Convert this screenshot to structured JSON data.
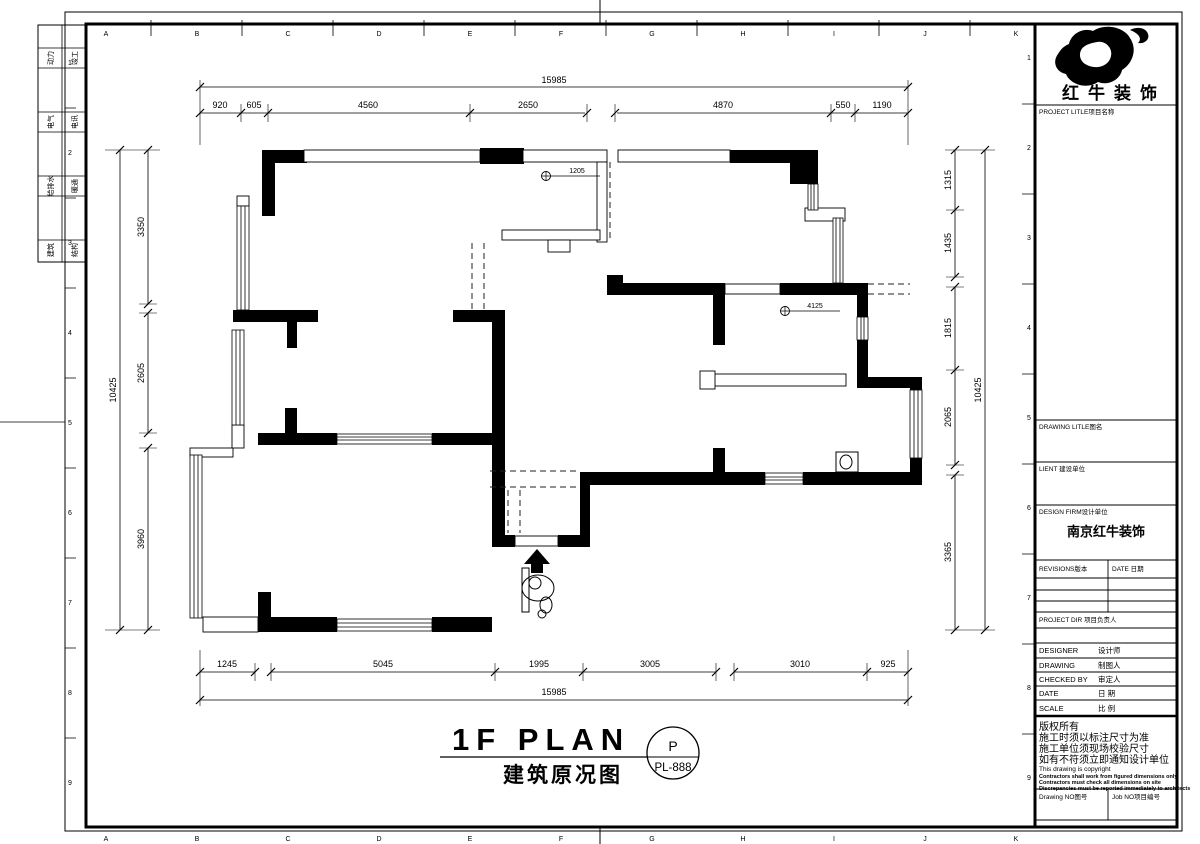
{
  "sheet": {
    "grid_letters": [
      "A",
      "B",
      "C",
      "D",
      "E",
      "F",
      "G",
      "H",
      "I",
      "J",
      "K"
    ],
    "fold_numbers": [
      "1",
      "2",
      "3",
      "4",
      "5",
      "6",
      "7",
      "8",
      "9"
    ],
    "disciplines_col1": [
      "动力",
      "电气",
      "给排水",
      "建筑"
    ],
    "disciplines_col2": [
      "竣工",
      "电讯",
      "暖通",
      "结构"
    ]
  },
  "title_block": {
    "logo_text": "红牛装饰",
    "project_label": "PROJECT LITLE项目名称",
    "drawing_title_label": "DRAWING LITLE图名",
    "client_label": "LIENT 建设单位",
    "design_firm_label": "DESIGN FIRM设计单位",
    "design_firm_name": "南京红牛装饰",
    "revisions_label": "REVISIONS版本",
    "revisions_date_label": "DATE 日期",
    "project_dir_label": "PROJECT DIR 项目负责人",
    "designer_label": "DESIGNER",
    "designer_cn": "设计师",
    "drawing_label": "DRAWING",
    "drawing_cn": "制图人",
    "checked_label": "CHECKED BY",
    "checked_cn": "审定人",
    "date_label": "DATE",
    "date_cn": "日 期",
    "scale_label": "SCALE",
    "scale_cn": "比 例",
    "copyright_line1": "版权所有",
    "copyright_line2": "施工时须以标注尺寸为准",
    "copyright_line3": "施工单位须现场校验尺寸",
    "copyright_line4": "如有不符须立即通知设计单位",
    "copyright_line5": "This drawing is copyright",
    "copyright_small1": "Contractors shall work from figured dimensions only",
    "copyright_small2": "Contractors must check all dimensions on site",
    "copyright_small3": "Discrepancies must be reported immediately to architects",
    "drawing_no_label": "Drawing NO图号",
    "job_no_label": "Job NO项目编号"
  },
  "plan": {
    "title_en": "1F PLAN",
    "title_cn": "建筑原况图",
    "stamp_letter": "P",
    "stamp_code": "PL-888",
    "datum_label_1": "1205",
    "datum_label_2": "4125"
  },
  "dimensions": {
    "top_overall": "15985",
    "top_segments": [
      "920",
      "605",
      "4560",
      "2650",
      "4870",
      "550",
      "1190"
    ],
    "bottom_segments": [
      "1245",
      "5045",
      "1995",
      "3005",
      "3010",
      "925"
    ],
    "bottom_overall": "15985",
    "left_overall": "10425",
    "left_segments": [
      "3350",
      "2605",
      "3960"
    ],
    "right_segments": [
      "1315",
      "1435",
      "1815",
      "2065",
      "3365"
    ],
    "right_overall": "10425"
  }
}
